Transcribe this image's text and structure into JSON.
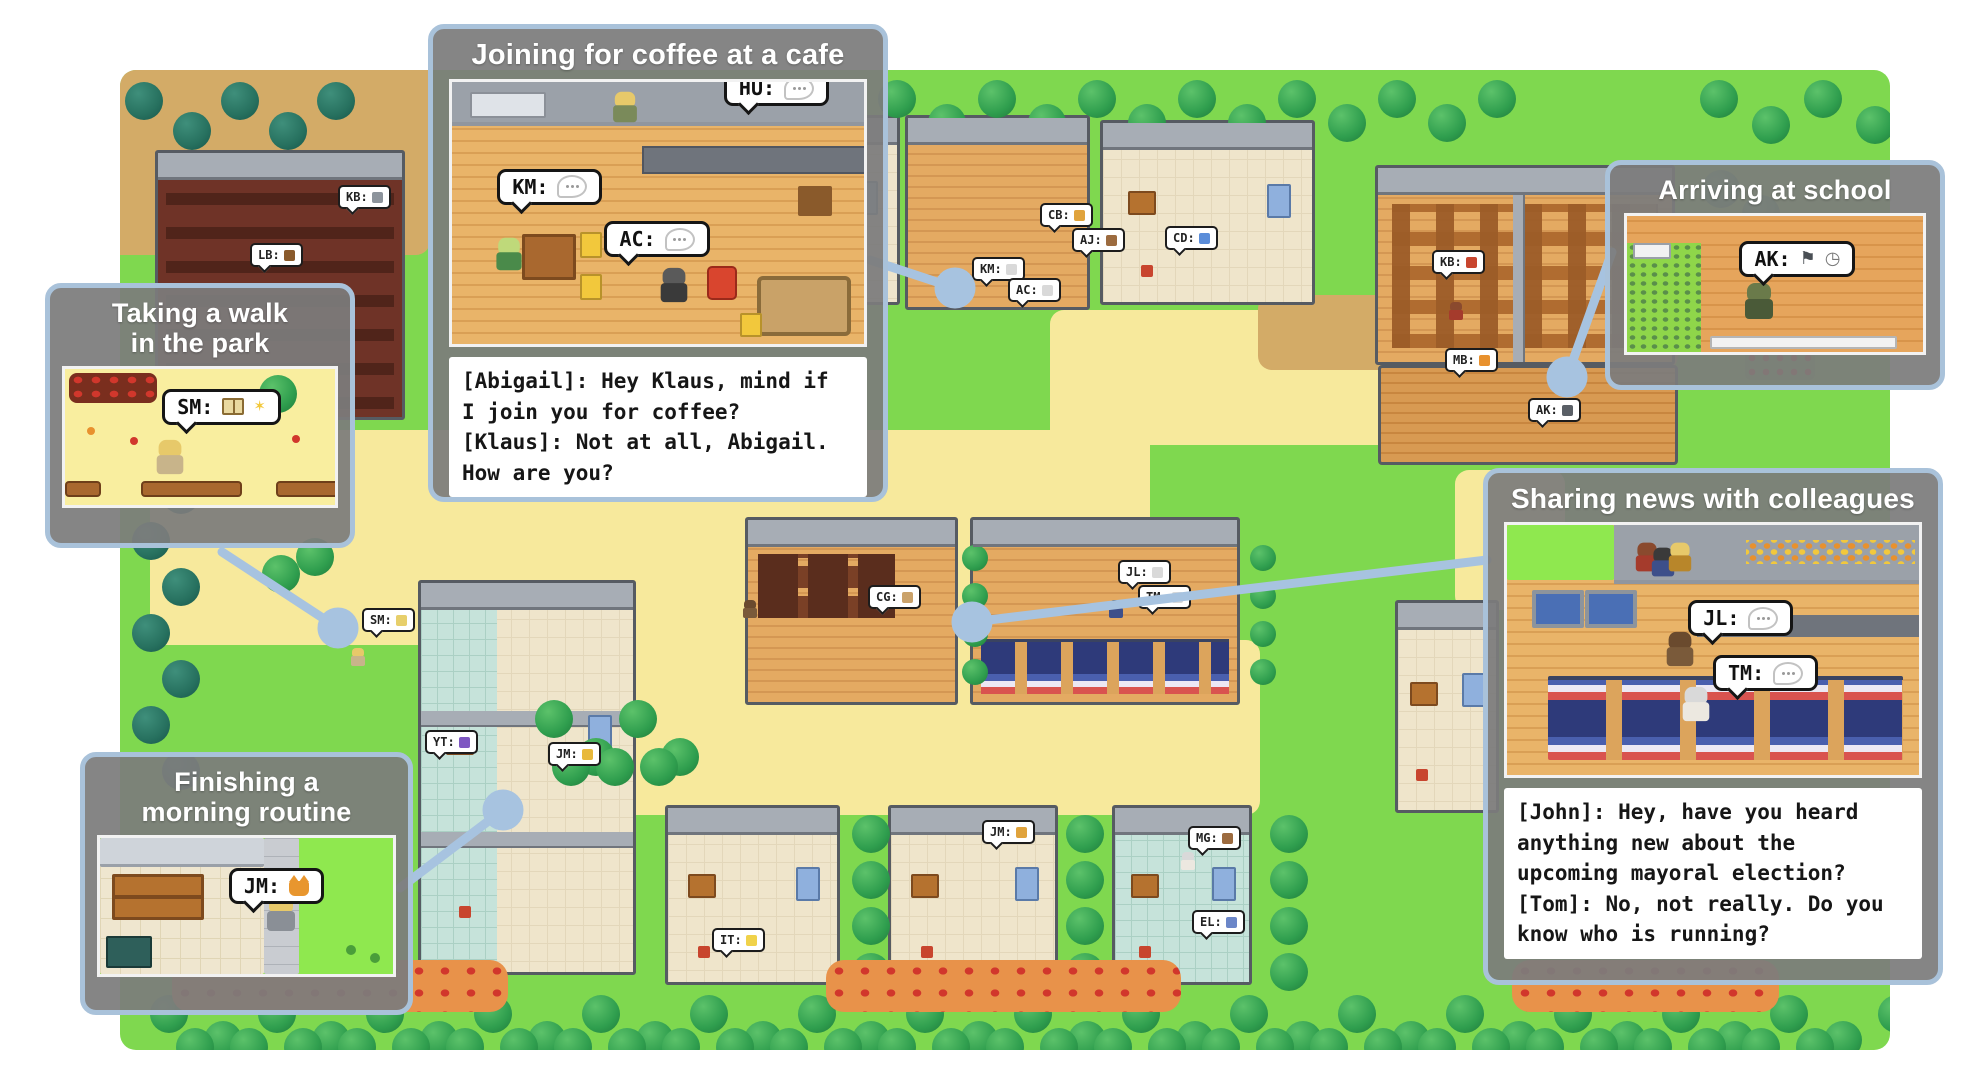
{
  "panels": {
    "cafe": {
      "title": "Joining for coffee at a cafe",
      "bubbles": [
        {
          "label": "HU:",
          "icon": "speech-ellipsis"
        },
        {
          "label": "KM:",
          "icon": "speech-ellipsis"
        },
        {
          "label": "AC:",
          "icon": "speech-ellipsis"
        }
      ],
      "dialogue": "[Abigail]: Hey Klaus, mind if\nI join you for coffee?\n[Klaus]: Not at all, Abigail.\nHow are you?"
    },
    "park": {
      "title_lines": [
        "Taking a walk",
        "in the park"
      ],
      "bubbles": [
        {
          "label": "SM:",
          "icon": "book-sparkle"
        }
      ]
    },
    "morning": {
      "title_lines": [
        "Finishing a",
        "morning routine"
      ],
      "bubbles": [
        {
          "label": "JM:",
          "icon": "cat"
        }
      ]
    },
    "school": {
      "title": "Arriving at school",
      "bubbles": [
        {
          "label": "AK:",
          "icon": "flag-clock"
        }
      ]
    },
    "colleagues": {
      "title": "Sharing news with colleagues",
      "bubbles": [
        {
          "label": "JL:",
          "icon": "speech-ellipsis"
        },
        {
          "label": "TM:",
          "icon": "speech-ellipsis"
        }
      ],
      "dialogue": "[John]: Hey, have you heard\nanything new about the\nupcoming mayoral election?\n[Tom]: No, not really. Do you\nknow who is running?"
    }
  },
  "map": {
    "bubbles": [
      {
        "label": "LB:",
        "icon": "book-pencil",
        "icon_color": "#8a5a2b",
        "x": 250,
        "y": 243
      },
      {
        "label": "KB:",
        "icon": "wrench",
        "icon_color": "#8d949c",
        "x": 338,
        "y": 185
      },
      {
        "label": "RP:",
        "icon": "wrench",
        "icon_color": "#8d949c",
        "x": 712,
        "y": 198
      },
      {
        "label": "CB:",
        "icon": "bread-cheese",
        "icon_color": "#e0a33c",
        "x": 1040,
        "y": 203
      },
      {
        "label": "AJ:",
        "icon": "coffee",
        "icon_color": "#9c6b3f",
        "x": 1072,
        "y": 228
      },
      {
        "label": "KM:",
        "icon": "speech",
        "icon_color": "#d9d9d9",
        "x": 972,
        "y": 257
      },
      {
        "label": "AC:",
        "icon": "speech",
        "icon_color": "#d9d9d9",
        "x": 1008,
        "y": 278
      },
      {
        "label": "CD:",
        "icon": "gift",
        "icon_color": "#5b8dd9",
        "x": 1165,
        "y": 226
      },
      {
        "label": "KB:",
        "icon": "apple-coffee",
        "icon_color": "#c8452e",
        "x": 1432,
        "y": 250
      },
      {
        "label": "MB:",
        "icon": "orange",
        "icon_color": "#e8912e",
        "x": 1445,
        "y": 348
      },
      {
        "label": "AK:",
        "icon": "flag-clock",
        "icon_color": "#5a5f66",
        "x": 1528,
        "y": 398
      },
      {
        "label": "SM:",
        "icon": "book-sparkle",
        "icon_color": "#e7cf6b",
        "x": 362,
        "y": 608
      },
      {
        "label": "CG:",
        "icon": "thumbs-up",
        "icon_color": "#caa26a",
        "x": 868,
        "y": 585
      },
      {
        "label": "JL:",
        "icon": "speech",
        "icon_color": "#d9d9d9",
        "x": 1118,
        "y": 560
      },
      {
        "label": "TM:",
        "icon": "speech",
        "icon_color": "#d9d9d9",
        "x": 1138,
        "y": 585
      },
      {
        "label": "YT:",
        "icon": "book-tool",
        "icon_color": "#7e57c2",
        "x": 425,
        "y": 730
      },
      {
        "label": "JM:",
        "icon": "lock",
        "icon_color": "#e8b93c",
        "x": 548,
        "y": 742
      },
      {
        "label": "JM:",
        "icon": "bread",
        "icon_color": "#e0a33c",
        "x": 982,
        "y": 820
      },
      {
        "label": "IT:",
        "icon": "egg-pan",
        "icon_color": "#f0d24a",
        "x": 712,
        "y": 928
      },
      {
        "label": "MG:",
        "icon": "coffee-egg",
        "icon_color": "#9c6b3f",
        "x": 1188,
        "y": 826
      },
      {
        "label": "EL:",
        "icon": "bed",
        "icon_color": "#6b86c8",
        "x": 1192,
        "y": 910
      }
    ]
  },
  "colors": {
    "grass": "#7fd84f",
    "sand_path": "#f7e99c",
    "dirt_path": "#d3ab67",
    "deck": "#d89a52",
    "building_wall": "#a7adb5",
    "wood_floor": "#e4aa62",
    "panel_border": "#a9c2da",
    "panel_background": "#7c7c7c",
    "connector": "#a7c3e0",
    "dialogue_background": "#ffffff",
    "tree_green": "#2f9e4e",
    "tree_teal": "#27715f",
    "flowerbed": "#e8924a"
  }
}
